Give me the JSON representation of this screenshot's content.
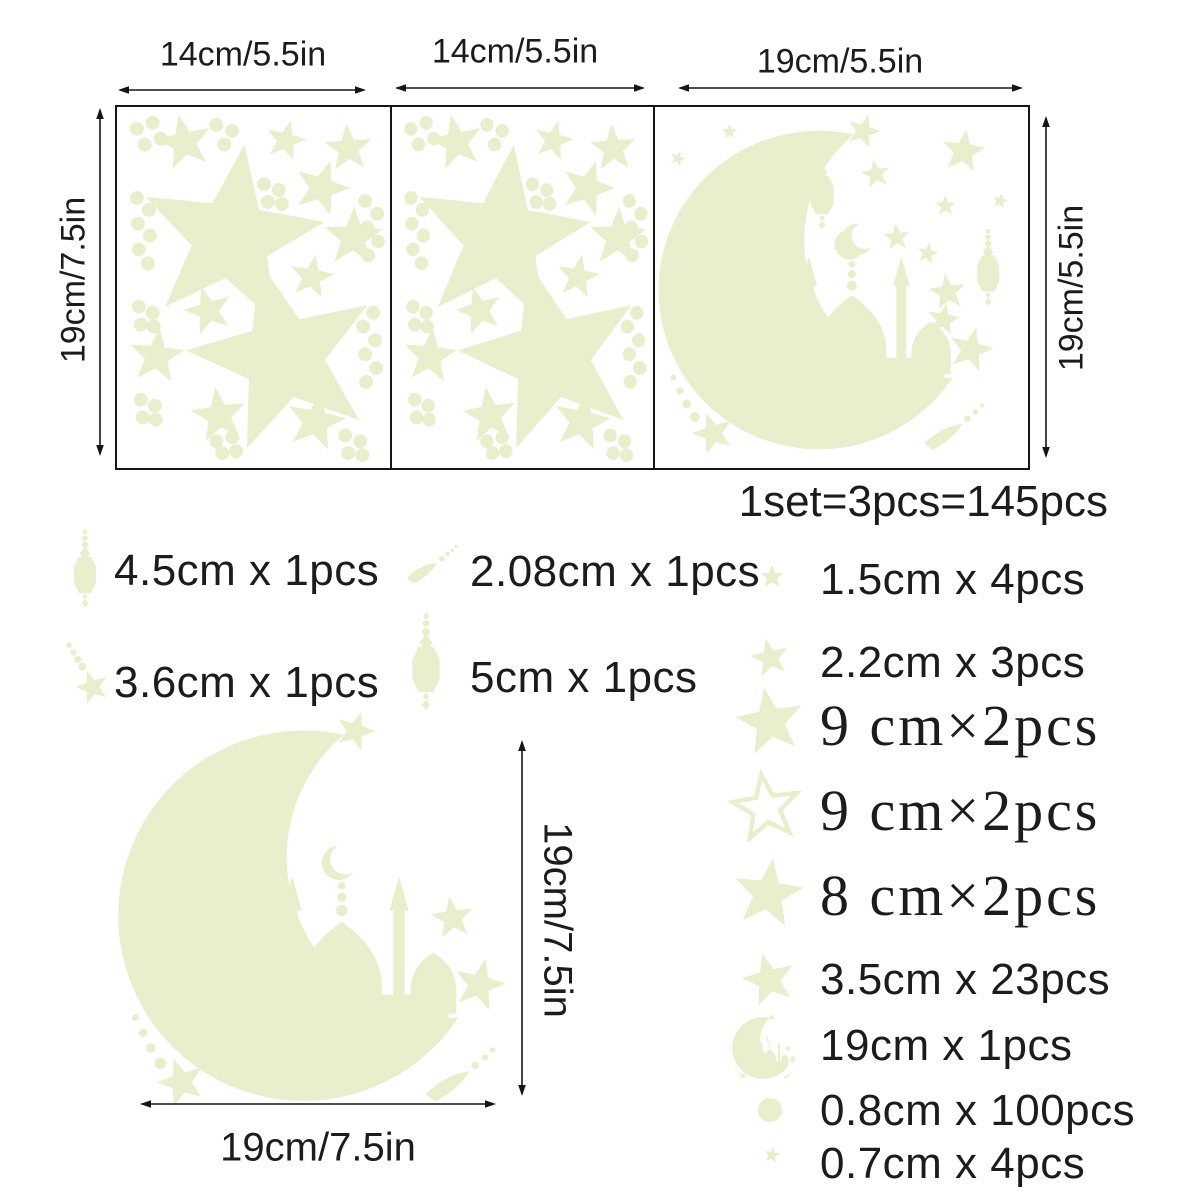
{
  "colors": {
    "sticker": "#e8efcd",
    "text": "#1c1c1c"
  },
  "sheets": {
    "panel1_width_label": "14cm/5.5in",
    "panel2_width_label": "14cm/5.5in",
    "panel3_width_label": "19cm/5.5in",
    "left_height_label": "19cm/7.5in",
    "right_height_label": "19cm/5.5in"
  },
  "set_info": "1set=3pcs=145pcs",
  "specs": {
    "left": [
      {
        "icon": "lantern-icon",
        "label": "4.5cm x 1pcs"
      },
      {
        "icon": "star-trail-icon",
        "label": "3.6cm x 1pcs"
      }
    ],
    "middle": [
      {
        "icon": "comet-icon",
        "label": "2.08cm x 1pcs"
      },
      {
        "icon": "lantern-icon",
        "label": "5cm x 1pcs"
      }
    ],
    "right": [
      {
        "icon": "star-icon",
        "label": "1.5cm x 4pcs"
      },
      {
        "icon": "star-icon",
        "label": "2.2cm x 3pcs"
      },
      {
        "icon": "star-icon",
        "label": "9 cm×2pcs"
      },
      {
        "icon": "star-outline-icon",
        "label": "9 cm×2pcs"
      },
      {
        "icon": "star-icon",
        "label": "8 cm×2pcs"
      },
      {
        "icon": "star-icon",
        "label": "3.5cm x 23pcs"
      },
      {
        "icon": "moon-mosque-icon",
        "label": "19cm x 1pcs"
      },
      {
        "icon": "dot-icon",
        "label": "0.8cm x 100pcs"
      },
      {
        "icon": "star-icon",
        "label": "0.7cm x 4pcs"
      }
    ]
  },
  "large_moon": {
    "height_label": "19cm/7.5in",
    "width_label": "19cm/7.5in"
  }
}
